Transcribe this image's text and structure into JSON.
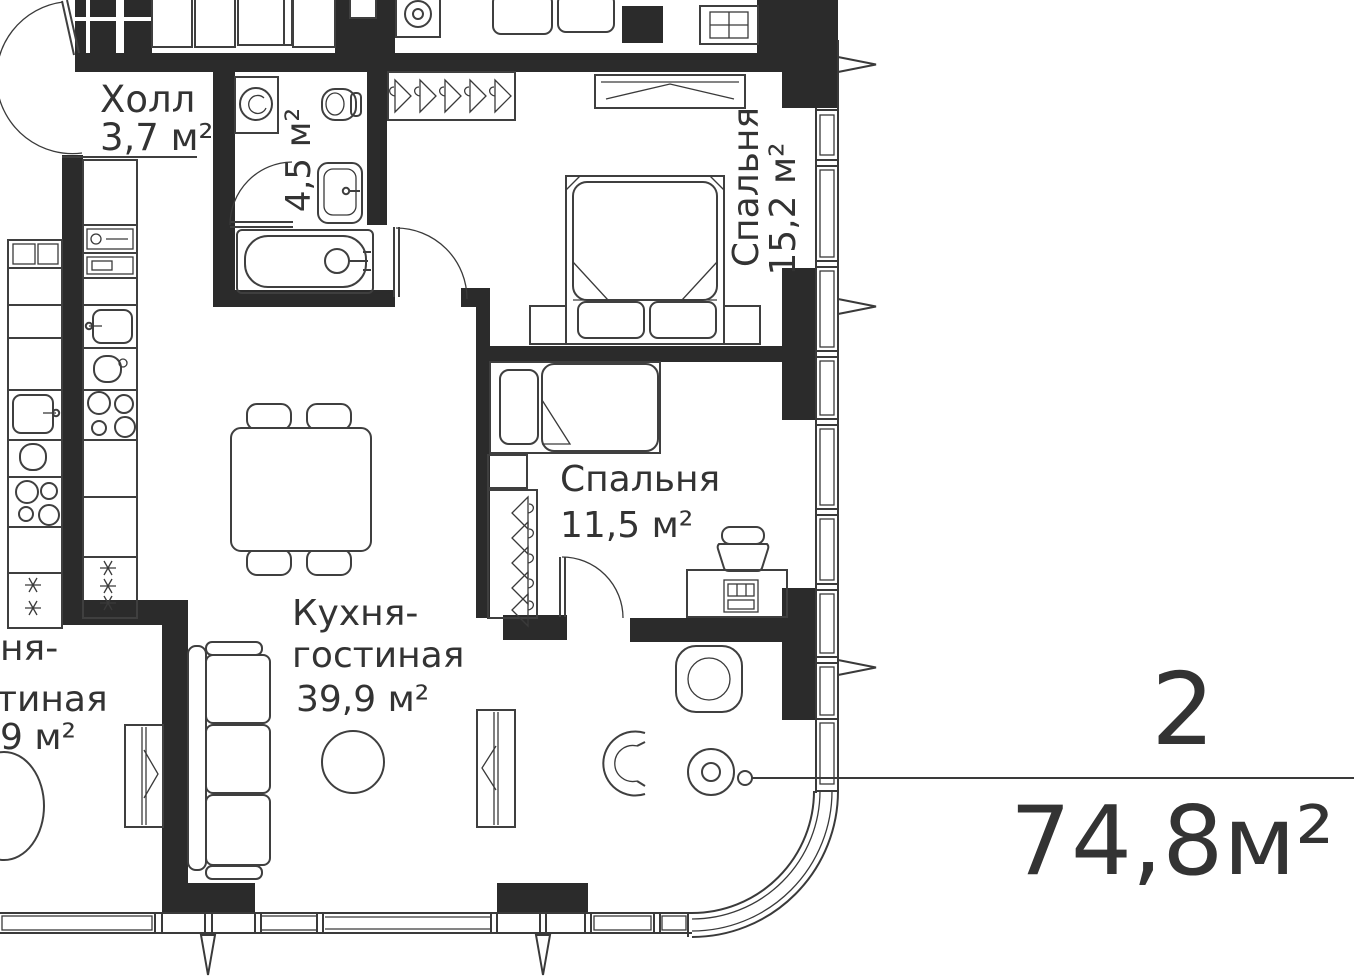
{
  "plan": {
    "title": "apartment floor plan",
    "rooms": [
      {
        "key": "hall",
        "label": "Холл",
        "area": "3,7 м²"
      },
      {
        "key": "bathroom",
        "label": "",
        "area": "4,5 м²"
      },
      {
        "key": "bedroom_main",
        "label": "Спальня",
        "area": "15,2 м²"
      },
      {
        "key": "bedroom_second",
        "label": "Спальня",
        "area": "11,5 м²"
      },
      {
        "key": "kitchen_living",
        "label_line1": "Кухня-",
        "label_line2": "гостиная",
        "area": "39,9 м²"
      }
    ],
    "neighbor_fragments": {
      "line1": "ня-",
      "line2": "тиная",
      "line3": "9 м²"
    },
    "unit_badge": {
      "rooms_count": "2",
      "total_area": "74,8м²"
    }
  },
  "colors": {
    "wall": "#2b2b2b",
    "line": "#3a3a3a",
    "furniture": "#3f3f3f",
    "text": "#333333",
    "background": "#ffffff"
  }
}
